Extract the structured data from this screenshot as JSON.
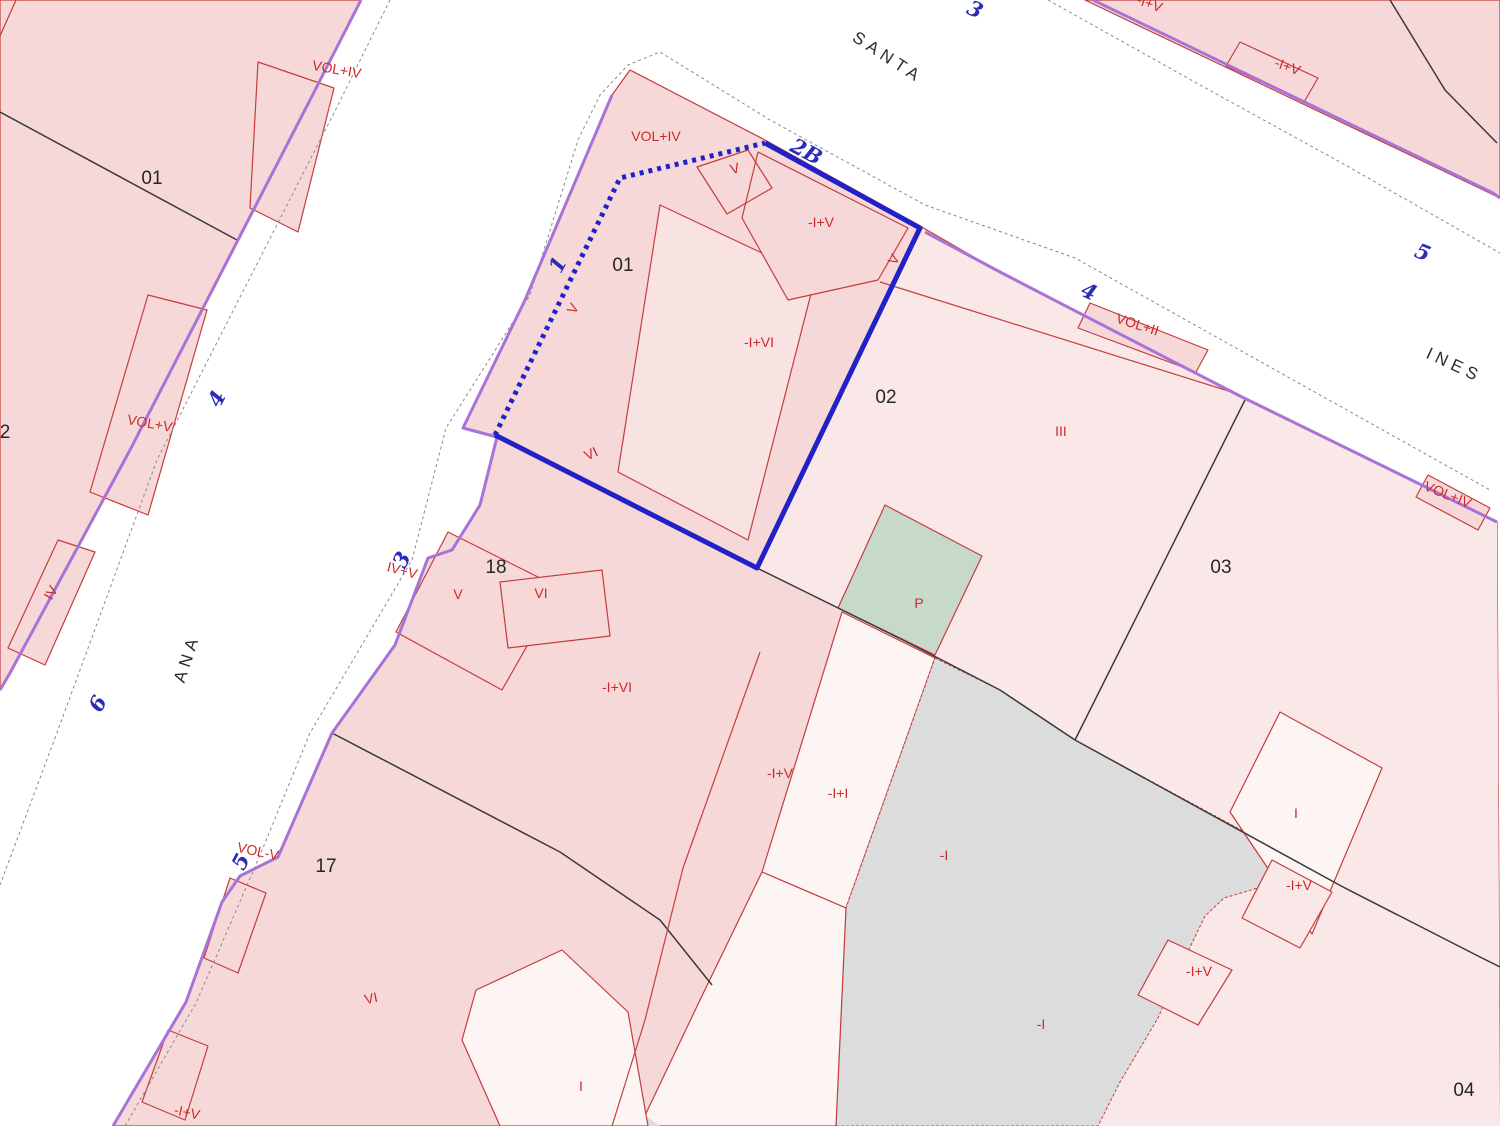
{
  "map": {
    "width": 1500,
    "height": 1126,
    "background": "#ffffff",
    "colors": {
      "blockDark": "#f6d8d8",
      "blockLight": "#fae8e8",
      "buildingLight": "#f9e2e2",
      "white": "#fdf4f4",
      "gray": "#dcdcdc",
      "green": "#c7d9cb",
      "red": "#c43d3d",
      "purple": "#a873d6",
      "blue": "#2121c8",
      "black": "#3a3a3a",
      "casing": "#8a8a8a"
    }
  },
  "regions": [
    {
      "name": "block-west-of-ana",
      "pts": "0,0 361,0 310,100 130,450 10,673 0,690",
      "fill": "blockDark",
      "stroke": "red",
      "inter": true
    },
    {
      "name": "block-northeast",
      "pts": "1085,0 1500,0 1500,198",
      "fill": "blockDark",
      "stroke": "red",
      "inter": true
    },
    {
      "name": "block-central",
      "pts": "630,70 765,140 920,226 1000,272 1240,396 1497,522 1500,1126 113,1126 186,1002 222,902 240,876 278,857 332,733 395,645 428,558 452,550 480,505 497,437 463,428 525,300 612,95",
      "fill": "blockDark",
      "stroke": "red",
      "inter": true
    },
    {
      "name": "parcel-02-03-04-light-area",
      "pts": "920,228 1240,396 1497,522 1500,1126 1098,1126 1120,1082 1158,1018 1178,972 1205,916 1224,898 1268,885 1300,862 1075,740 1000,690 903,640 757,568",
      "fill": "blockLight",
      "inter": true
    },
    {
      "name": "building-main-parcel-01",
      "pts": "660,205 815,278 748,540 618,472",
      "fill": "buildingLight",
      "stroke": "red",
      "inter": true
    },
    {
      "name": "subparcel-iv-top",
      "pts": "758,152 908,228 878,280 788,300 742,218",
      "fill": "blockDark",
      "stroke": "red",
      "inter": false
    },
    {
      "name": "subparcel-v-top",
      "pts": "697,167 748,150 772,188 727,214",
      "stroke": "red",
      "inter": false
    },
    {
      "name": "building-vol-ii",
      "pts": "1090,303 1208,350 1196,372 1078,328",
      "fill": "blockDark",
      "stroke": "red",
      "inter": false
    },
    {
      "name": "building-vol-iv-east",
      "pts": "1428,475 1490,508 1478,530 1416,497",
      "fill": "blockDark",
      "stroke": "red",
      "inter": false
    },
    {
      "name": "building-west-1",
      "pts": "258,62 334,88 298,232 250,208",
      "fill": "blockDark",
      "stroke": "red",
      "inter": false
    },
    {
      "name": "building-vol-v-west",
      "pts": "148,295 207,310 148,515 90,492",
      "fill": "blockDark",
      "stroke": "red",
      "inter": false
    },
    {
      "name": "building-iv-west",
      "pts": "58,540 95,552 45,665 8,648",
      "fill": "blockDark",
      "stroke": "red",
      "inter": false
    },
    {
      "name": "building-ana-balcony-1",
      "pts": "230,878 266,893 238,973 204,958",
      "fill": "blockDark",
      "stroke": "red",
      "inter": false
    },
    {
      "name": "building-ana-balcony-2",
      "pts": "168,1030 208,1046 185,1120 142,1102",
      "fill": "blockDark",
      "stroke": "red",
      "inter": false
    },
    {
      "name": "building-v-parcel-18",
      "pts": "448,532 560,588 502,690 396,632",
      "fill": "blockDark",
      "stroke": "red",
      "inter": false
    },
    {
      "name": "building-vi-parcel-18",
      "pts": "500,582 602,570 610,636 508,648",
      "fill": "blockDark",
      "stroke": "red",
      "inter": false
    },
    {
      "name": "building-white-center",
      "pts": "842,612 935,658 846,908 762,872",
      "fill": "white",
      "stroke": "red",
      "inter": false
    },
    {
      "name": "courtyard-gray-main",
      "pts": "935,658 1000,690 1075,740 1300,862 1268,885 1224,898 1205,916 1178,972 1158,1018 1120,1082 1098,1126 836,1126 846,908",
      "fill": "gray",
      "stroke": "red",
      "sw": 1,
      "dash": "3 2",
      "inter": false
    },
    {
      "name": "building-white-lower",
      "pts": "762,872 846,908 836,1126 640,1126 700,1000",
      "fill": "white",
      "stroke": "red",
      "inter": false
    },
    {
      "name": "courtyard-gray-small",
      "pts": "598,1082 660,1126 598,1126",
      "fill": "gray",
      "inter": false
    },
    {
      "name": "building-white-parcel-17",
      "pts": "476,990 562,950 628,1012 648,1126 500,1126 462,1040",
      "fill": "white",
      "stroke": "red",
      "inter": false
    },
    {
      "name": "patio-green",
      "pts": "885,505 982,556 935,655 838,608",
      "fill": "green",
      "stroke": "red",
      "inter": false
    },
    {
      "name": "building-white-parcel-03",
      "pts": "1280,712 1382,768 1312,934 1230,812",
      "fill": "white",
      "stroke": "red",
      "inter": false
    },
    {
      "name": "building-q1-parcel-03",
      "pts": "1272,860 1332,892 1300,948 1242,918",
      "fill": "blockLight",
      "stroke": "red",
      "inter": false
    },
    {
      "name": "building-q2-parcel-03",
      "pts": "1168,940 1232,970 1198,1025 1138,995",
      "fill": "blockLight",
      "stroke": "red",
      "inter": false
    },
    {
      "name": "building-northeast-small",
      "pts": "1240,42 1318,78 1304,102 1226,66",
      "fill": "blockDark",
      "stroke": "red",
      "inter": false
    }
  ],
  "lines": [
    {
      "name": "street-casing-ana-west",
      "pts": "390,0 337,107 157,460 58,730 0,885",
      "stroke": "casing",
      "w": 1,
      "dash": "3 3"
    },
    {
      "name": "street-casing-ana-santa-east",
      "pts": "125,1126 196,1003 258,860 310,733 412,560 446,428 530,295 578,140 600,95 628,65 660,52 770,120 925,205 1075,258 1490,490",
      "stroke": "casing",
      "w": 1,
      "dash": "3 3"
    },
    {
      "name": "street-casing-ines-north",
      "pts": "1048,0 1200,85 1340,162 1500,253",
      "stroke": "casing",
      "w": 1,
      "dash": "3 3"
    },
    {
      "name": "boundary-west-01-02",
      "pts": "0,112 237,240",
      "stroke": "black",
      "w": 1.5
    },
    {
      "name": "boundary-02-03",
      "pts": "1245,400 1075,740",
      "stroke": "black",
      "w": 1.5
    },
    {
      "name": "boundary-02-south",
      "pts": "757,568 903,640 1000,690 1075,740",
      "stroke": "black",
      "w": 1.5
    },
    {
      "name": "boundary-03-04",
      "pts": "1075,740 1343,887 1480,957 1500,967",
      "stroke": "black",
      "w": 1.5
    },
    {
      "name": "boundary-17-18",
      "pts": "332,733 560,852 660,920 712,985",
      "stroke": "black",
      "w": 1.5
    },
    {
      "name": "boundary-northeast-block",
      "pts": "1390,0 1445,90 1497,143",
      "stroke": "black",
      "w": 1.5
    },
    {
      "name": "subboundary-strip",
      "pts": "760,652 683,868 645,1020 612,1126",
      "stroke": "red",
      "w": 1.2
    },
    {
      "name": "subboundary-02",
      "pts": "880,282 1238,394",
      "stroke": "red",
      "w": 1.2
    },
    {
      "name": "corner-mark-red",
      "pts": "0,36 16,0",
      "stroke": "red",
      "w": 1.2
    },
    {
      "name": "street-edge-purple-west-block",
      "pts": "361,0 310,100 130,450 10,673 0,690",
      "stroke": "purple",
      "w": 3
    },
    {
      "name": "street-edge-purple-central-block",
      "pts": "612,95 525,300 463,428 497,437 480,505 452,550 428,558 395,645 332,733 278,857 240,876 222,902 186,1002 113,1126",
      "stroke": "purple",
      "w": 3
    },
    {
      "name": "street-edge-purple-northeast-block",
      "pts": "1093,0 1493,193 1500,198",
      "stroke": "purple",
      "w": 3
    },
    {
      "name": "street-edge-purple-ines-south",
      "pts": "925,232 1000,272 1240,396 1497,522",
      "stroke": "purple",
      "w": 3
    }
  ],
  "highlight_parcel": {
    "solid_pts": "765,143 920,228 757,568 495,435",
    "dotted_pts": "495,435 620,178 765,143",
    "color": "blue",
    "width": 5,
    "dash": "4 5"
  },
  "labels": {
    "streets": [
      {
        "text": "SANTA",
        "x": 885,
        "y": 62,
        "rot": 33
      },
      {
        "text": "INES",
        "x": 1452,
        "y": 370,
        "rot": 25
      },
      {
        "text": "ANA",
        "x": 192,
        "y": 660,
        "rot": -72
      }
    ],
    "addresses": [
      {
        "text": "3",
        "x": 972,
        "y": 16,
        "rot": 25
      },
      {
        "text": "2B",
        "x": 803,
        "y": 158,
        "rot": 28,
        "size": 23
      },
      {
        "text": "5",
        "x": 1420,
        "y": 259,
        "rot": 22
      },
      {
        "text": "4",
        "x": 1086,
        "y": 298,
        "rot": 25
      },
      {
        "text": "1",
        "x": 564,
        "y": 268,
        "rot": -62
      },
      {
        "text": "3",
        "x": 408,
        "y": 563,
        "rot": -62
      },
      {
        "text": "4",
        "x": 223,
        "y": 402,
        "rot": -62
      },
      {
        "text": "6",
        "x": 104,
        "y": 707,
        "rot": -62
      },
      {
        "text": "5",
        "x": 247,
        "y": 865,
        "rot": -62
      }
    ],
    "parcels": [
      {
        "text": "01",
        "x": 152,
        "y": 184
      },
      {
        "text": "2",
        "x": 5,
        "y": 438
      },
      {
        "text": "01",
        "x": 623,
        "y": 271
      },
      {
        "text": "02",
        "x": 886,
        "y": 403
      },
      {
        "text": "03",
        "x": 1221,
        "y": 573
      },
      {
        "text": "04",
        "x": 1464,
        "y": 1096
      },
      {
        "text": "17",
        "x": 326,
        "y": 872
      },
      {
        "text": "18",
        "x": 496,
        "y": 573
      }
    ],
    "constructions": [
      {
        "text": "VOL+IV",
        "x": 336,
        "y": 74,
        "rot": 10
      },
      {
        "text": "VOL+IV",
        "x": 656,
        "y": 141
      },
      {
        "text": "-I+V",
        "x": 1148,
        "y": 8,
        "rot": 20
      },
      {
        "text": "-I+V",
        "x": 1286,
        "y": 71,
        "rot": 20
      },
      {
        "text": "V",
        "x": 736,
        "y": 173,
        "rot": -15
      },
      {
        "text": "-I+V",
        "x": 821,
        "y": 227
      },
      {
        "text": "V",
        "x": 898,
        "y": 262,
        "rot": -60
      },
      {
        "text": "-I+VI",
        "x": 759,
        "y": 347
      },
      {
        "text": "V",
        "x": 577,
        "y": 311,
        "rot": -60
      },
      {
        "text": "VOL+II",
        "x": 1136,
        "y": 329,
        "rot": 18
      },
      {
        "text": "III",
        "x": 1061,
        "y": 436
      },
      {
        "text": "VOL+IV",
        "x": 1446,
        "y": 499,
        "rot": 22
      },
      {
        "text": "VOL+V",
        "x": 149,
        "y": 428,
        "rot": 10
      },
      {
        "text": "IV",
        "x": 55,
        "y": 595,
        "rot": -60
      },
      {
        "text": "IV+V",
        "x": 401,
        "y": 575,
        "rot": 15
      },
      {
        "text": "VI",
        "x": 593,
        "y": 458,
        "rot": -25
      },
      {
        "text": "V",
        "x": 458,
        "y": 599
      },
      {
        "text": "VI",
        "x": 541,
        "y": 598
      },
      {
        "text": "-I+VI",
        "x": 617,
        "y": 692
      },
      {
        "text": "-I+V",
        "x": 780,
        "y": 778
      },
      {
        "text": "-I+I",
        "x": 838,
        "y": 798
      },
      {
        "text": "-I",
        "x": 944,
        "y": 860
      },
      {
        "text": "P",
        "x": 919,
        "y": 608,
        "size": 11
      },
      {
        "text": "VOL-V",
        "x": 257,
        "y": 856,
        "rot": 12
      },
      {
        "text": "VI",
        "x": 372,
        "y": 1003,
        "rot": -12
      },
      {
        "text": "I",
        "x": 581,
        "y": 1091
      },
      {
        "text": "-I+V",
        "x": 186,
        "y": 1117,
        "rot": 12
      },
      {
        "text": "I",
        "x": 1296,
        "y": 818
      },
      {
        "text": "-I+V",
        "x": 1299,
        "y": 890
      },
      {
        "text": "-I+V",
        "x": 1199,
        "y": 976
      },
      {
        "text": "-I",
        "x": 1041,
        "y": 1029
      }
    ]
  }
}
